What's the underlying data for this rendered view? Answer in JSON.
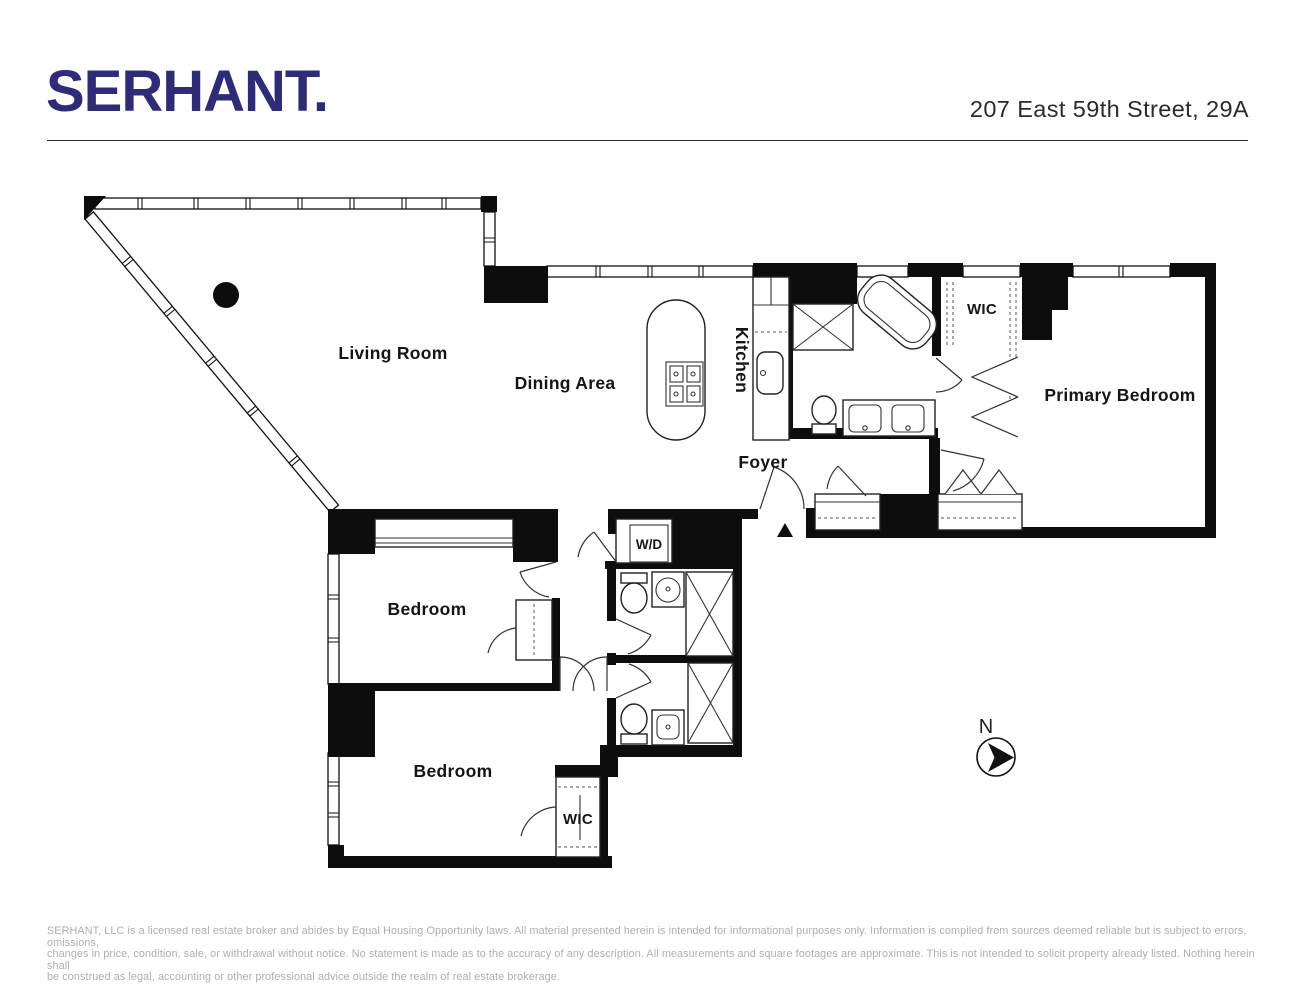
{
  "header": {
    "logo": "SERHANT.",
    "address": "207 East 59th Street, 29A"
  },
  "floorplan": {
    "rooms": {
      "living": "Living Room",
      "dining": "Dining Area",
      "kitchen": "Kitchen",
      "foyer": "Foyer",
      "wic_primary": "WIC",
      "primary_bedroom": "Primary Bedroom",
      "bedroom_upper": "Bedroom",
      "bedroom_lower": "Bedroom",
      "washer_dryer": "W/D",
      "wic_bedroom": "WIC"
    },
    "compass": {
      "north": "N"
    }
  },
  "footer": {
    "lines": [
      "SERHANT, LLC is a licensed real estate broker and abides by Equal Housing Opportunity laws. All material presented herein is intended for informational purposes only. Information is compiled from sources deemed  reliable but is subject to errors, omissions,",
      "changes in price, condition, sale, or withdrawal without notice. No statement is made as to the accuracy of any description. All measurements and square footages are approximate. This is not intended to solicit property already listed. Nothing herein shall",
      "be construed as legal, accounting or other professional advice outside the realm of real estate brokerage."
    ]
  },
  "colors": {
    "logo_navy": "#2e2b78",
    "wall_black": "#0d0d0d",
    "label_black": "#151515",
    "footer_gray": "#aeaeae"
  }
}
